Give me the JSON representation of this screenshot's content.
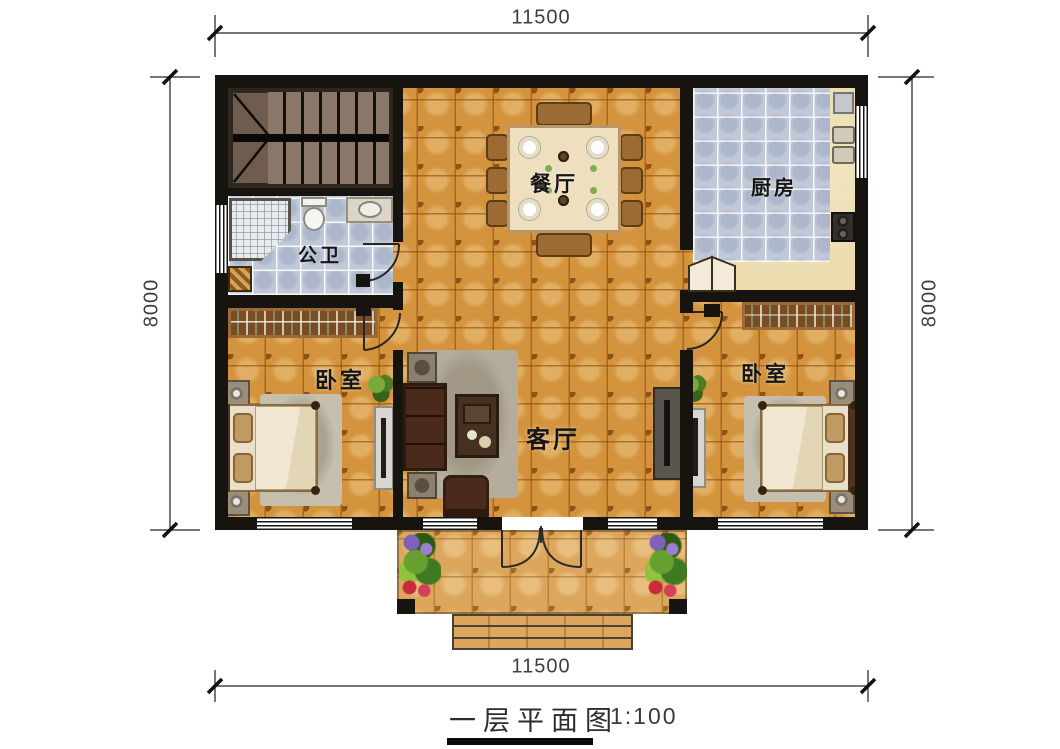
{
  "title": {
    "text": "一层平面图",
    "scale": "1:100"
  },
  "dimensions": {
    "top": "11500",
    "bottom": "11500",
    "left": "8000",
    "right": "8000"
  },
  "rooms": {
    "dining": {
      "label": "餐厅"
    },
    "kitchen": {
      "label": "厨房"
    },
    "bathroom": {
      "label": "公卫"
    },
    "bedroom_left": {
      "label": "卧室"
    },
    "bedroom_right": {
      "label": "卧室"
    },
    "living": {
      "label": "客厅"
    }
  },
  "colors": {
    "wall": "#17130e",
    "floor_tile_orange": "#d4943d",
    "floor_tile_blue": "#c1c9d9",
    "porch_tile": "#dca75c",
    "counter_wood": "#ecdcae",
    "dimension_line": "#4a4a4a"
  }
}
